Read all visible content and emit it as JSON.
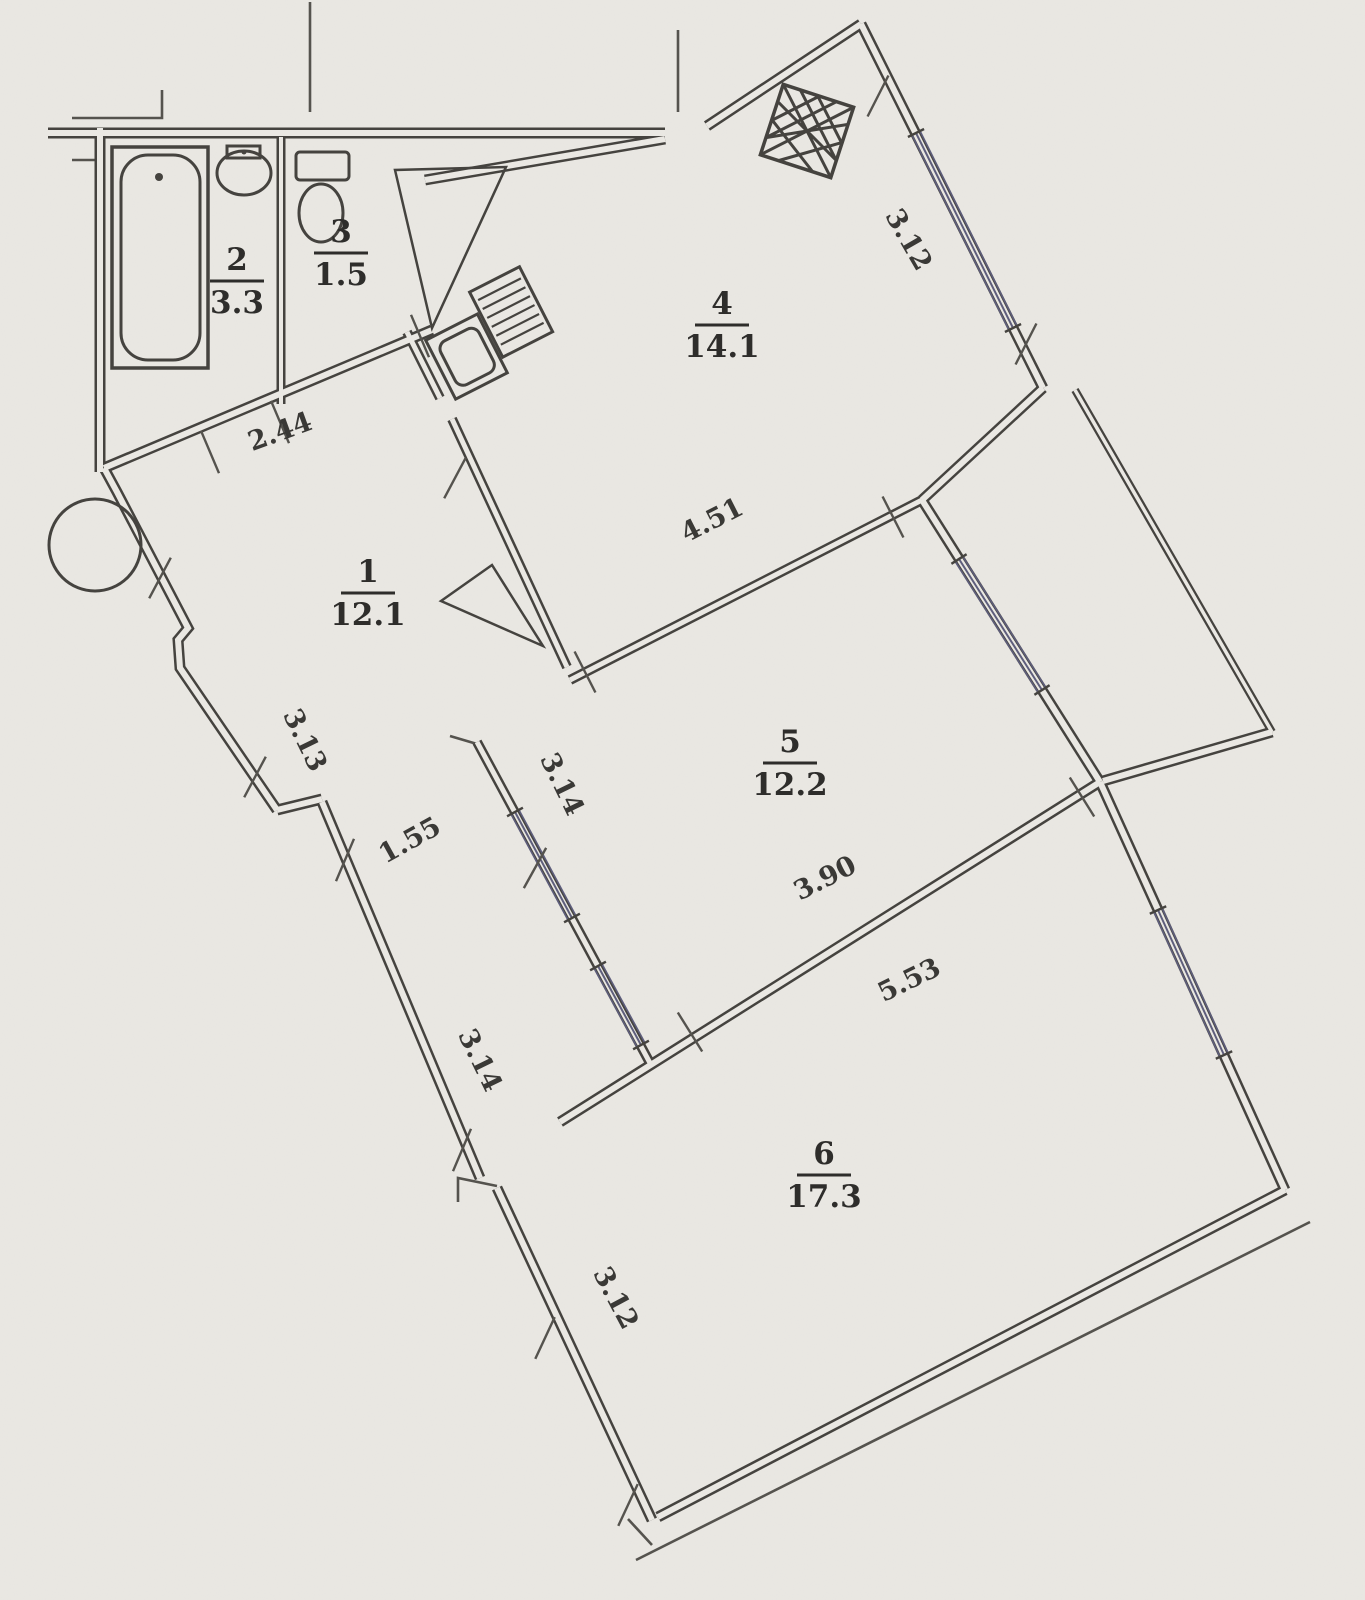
{
  "document": {
    "kind": "scanned apartment floor plan",
    "page_background": "#eae8e3"
  },
  "colors": {
    "background": "#eae8e3",
    "wall_line": "#45433f",
    "thin_line": "#55534e",
    "window_line": "#5e5e7c",
    "text": "#2e2d2b"
  },
  "rooms": [
    {
      "id": "room-1",
      "number": "1",
      "area": "12.1",
      "x": 368,
      "y": 592,
      "rotation": 0
    },
    {
      "id": "room-2",
      "number": "2",
      "area": "3.3",
      "x": 237,
      "y": 280,
      "rotation": 0
    },
    {
      "id": "room-3",
      "number": "3",
      "area": "1.5",
      "x": 341,
      "y": 252,
      "rotation": 0
    },
    {
      "id": "room-4",
      "number": "4",
      "area": "14.1",
      "x": 722,
      "y": 324,
      "rotation": 0
    },
    {
      "id": "room-5",
      "number": "5",
      "area": "12.2",
      "x": 790,
      "y": 762,
      "rotation": 0
    },
    {
      "id": "room-6",
      "number": "6",
      "area": "17.3",
      "x": 824,
      "y": 1174,
      "rotation": 0
    }
  ],
  "dimensions": [
    {
      "id": "dim-2-44",
      "value": "2.44",
      "x": 283,
      "y": 440,
      "rotation": -20
    },
    {
      "id": "dim-3-13",
      "value": "3.13",
      "x": 297,
      "y": 744,
      "rotation": 64
    },
    {
      "id": "dim-1-55",
      "value": "1.55",
      "x": 414,
      "y": 848,
      "rotation": -29
    },
    {
      "id": "dim-3-14a",
      "value": "3.14",
      "x": 554,
      "y": 788,
      "rotation": 64
    },
    {
      "id": "dim-3-14b",
      "value": "3.14",
      "x": 472,
      "y": 1064,
      "rotation": 64
    },
    {
      "id": "dim-4-51",
      "value": "4.51",
      "x": 716,
      "y": 528,
      "rotation": -27
    },
    {
      "id": "dim-3-12k",
      "value": "3.12",
      "x": 901,
      "y": 244,
      "rotation": 60
    },
    {
      "id": "dim-3-90",
      "value": "3.90",
      "x": 829,
      "y": 886,
      "rotation": -27
    },
    {
      "id": "dim-5-53",
      "value": "5.53",
      "x": 913,
      "y": 988,
      "rotation": -26
    },
    {
      "id": "dim-3-12r",
      "value": "3.12",
      "x": 608,
      "y": 1302,
      "rotation": 62
    }
  ]
}
